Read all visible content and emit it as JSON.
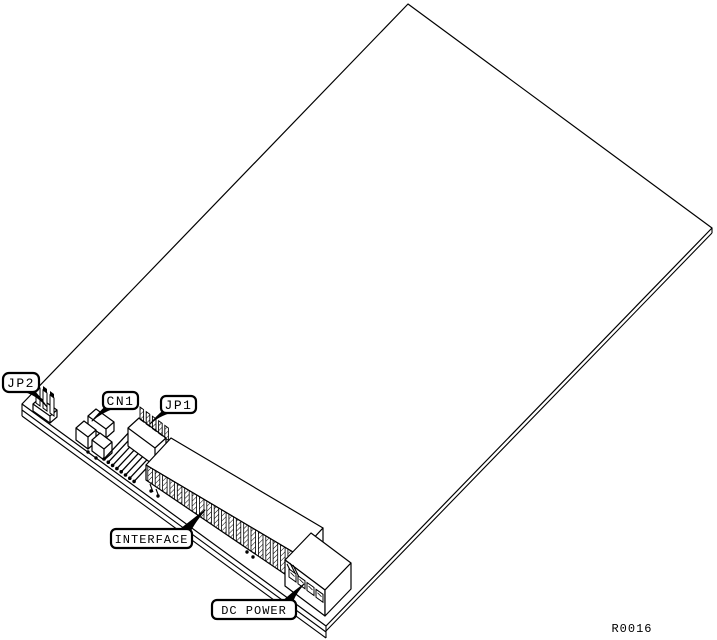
{
  "diagram": {
    "figure_reference": "R0016",
    "callouts": [
      {
        "id": "jp2",
        "label": "JP2"
      },
      {
        "id": "cn1",
        "label": "CN1"
      },
      {
        "id": "jp1",
        "label": "JP1"
      },
      {
        "id": "interface",
        "label": "INTERFACE"
      },
      {
        "id": "dc-power",
        "label": "DC POWER"
      }
    ],
    "colors": {
      "line": "#000000",
      "background": "#ffffff"
    }
  }
}
